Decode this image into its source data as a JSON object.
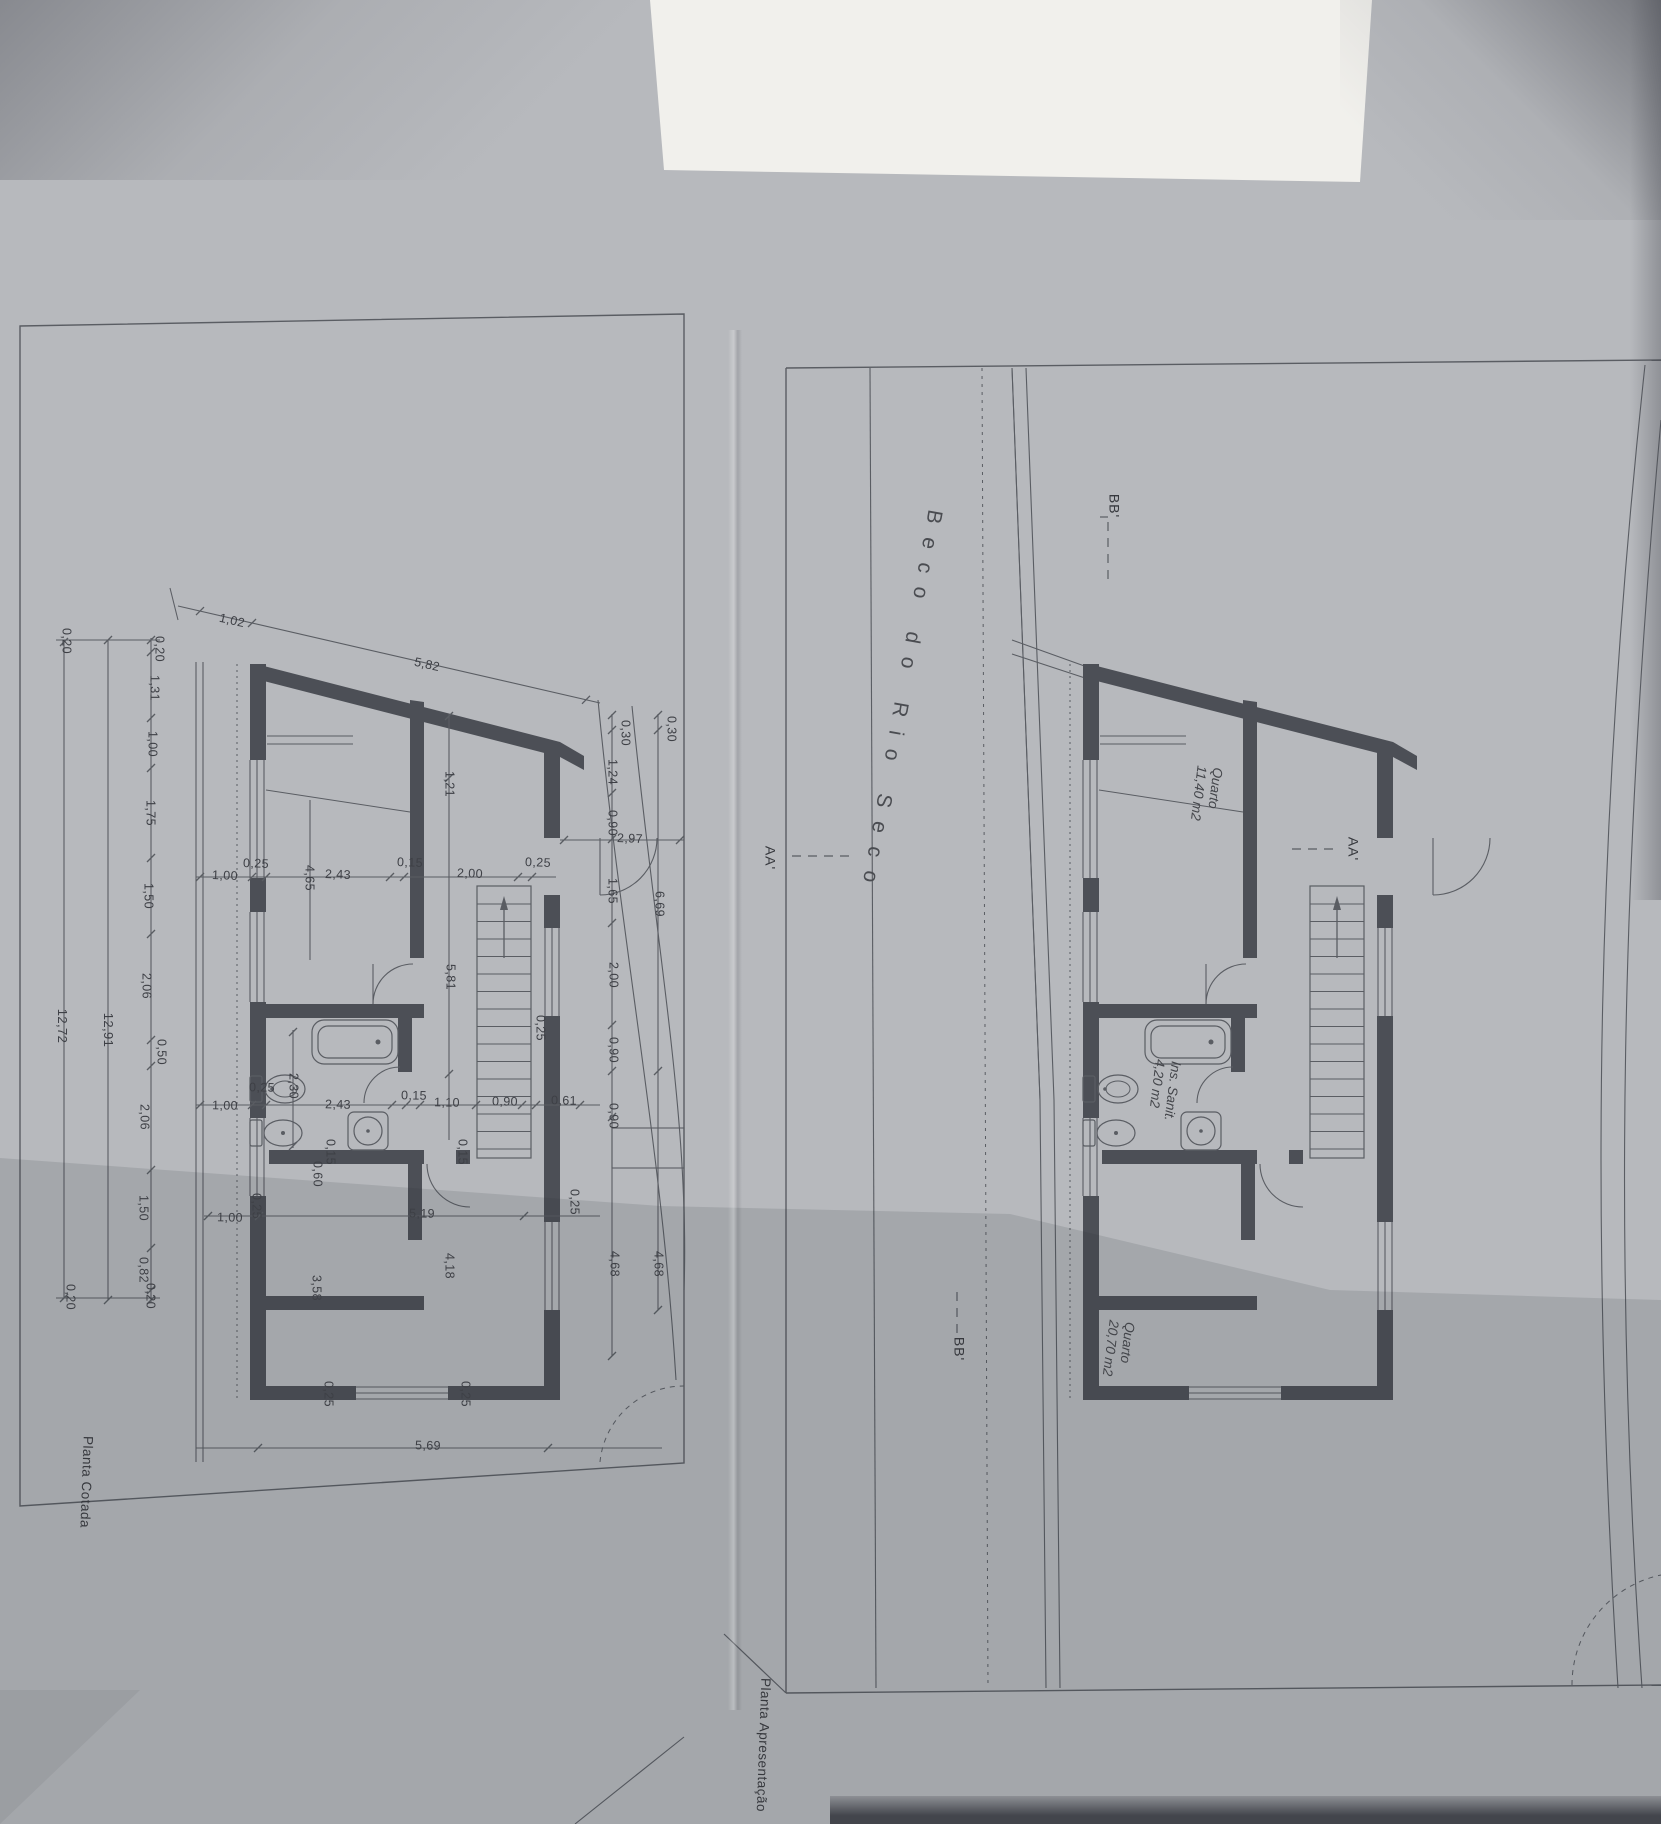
{
  "title": "Plantas de arquitetura (digitalização)",
  "street_label": {
    "text": "Beco do Rio Seco",
    "x": 901,
    "y": 703,
    "r": 100
  },
  "captions": {
    "left_plan": {
      "text": "Planta Cotada",
      "x": 86,
      "y": 1482,
      "r": 92
    },
    "right_plan": {
      "text": "Planta Apresentação",
      "x": 763,
      "y": 1745,
      "r": 92
    }
  },
  "section_markers": [
    {
      "t": "BB'",
      "x": 1114,
      "y": 506,
      "r": 90
    },
    {
      "t": "AA'",
      "x": 770,
      "y": 858,
      "r": 90
    },
    {
      "t": "AA'",
      "x": 1353,
      "y": 849,
      "r": 90
    },
    {
      "t": "BB'",
      "x": 959,
      "y": 1349,
      "r": 90
    }
  ],
  "rooms": [
    {
      "name": "Quarto",
      "area": "11,40 m2",
      "x": 1206,
      "y": 794,
      "r": 97
    },
    {
      "name": "Ins. Sanit.",
      "area": "4,20 m2",
      "x": 1164,
      "y": 1090,
      "r": 97
    },
    {
      "name": "Quarto",
      "area": "20,70 m2",
      "x": 1118,
      "y": 1349,
      "r": 97
    }
  ],
  "dimensions": [
    {
      "t": "1,02",
      "x": 232,
      "y": 621,
      "r": 13
    },
    {
      "t": "5,82",
      "x": 427,
      "y": 665,
      "r": 13
    },
    {
      "t": "0,20",
      "x": 159,
      "y": 649,
      "r": 90
    },
    {
      "t": "1,31",
      "x": 154,
      "y": 688,
      "r": 90
    },
    {
      "t": "1,00",
      "x": 152,
      "y": 744,
      "r": 90
    },
    {
      "t": "1,75",
      "x": 150,
      "y": 813,
      "r": 90
    },
    {
      "t": "1,50",
      "x": 148,
      "y": 896,
      "r": 90
    },
    {
      "t": "2,06",
      "x": 146,
      "y": 986,
      "r": 90
    },
    {
      "t": "0,50",
      "x": 161,
      "y": 1052,
      "r": 90
    },
    {
      "t": "2,06",
      "x": 144,
      "y": 1117,
      "r": 90
    },
    {
      "t": "1,50",
      "x": 143,
      "y": 1208,
      "r": 90
    },
    {
      "t": "0,82",
      "x": 143,
      "y": 1270,
      "r": 90
    },
    {
      "t": "0,20",
      "x": 150,
      "y": 1296,
      "r": 90
    },
    {
      "t": "12,91",
      "x": 108,
      "y": 1030,
      "r": 90
    },
    {
      "t": "0,20",
      "x": 66,
      "y": 641,
      "r": 90
    },
    {
      "t": "12,72",
      "x": 62,
      "y": 1026,
      "r": 90
    },
    {
      "t": "0,20",
      "x": 70,
      "y": 1297,
      "r": 90
    },
    {
      "t": "1,00",
      "x": 225,
      "y": 876,
      "r": 2
    },
    {
      "t": "0,25",
      "x": 256,
      "y": 864,
      "r": 2
    },
    {
      "t": "4,65",
      "x": 309,
      "y": 878,
      "r": 90
    },
    {
      "t": "2,43",
      "x": 338,
      "y": 875,
      "r": 2
    },
    {
      "t": "0,15",
      "x": 410,
      "y": 863,
      "r": 2
    },
    {
      "t": "2,00",
      "x": 470,
      "y": 874,
      "r": 2
    },
    {
      "t": "0,25",
      "x": 538,
      "y": 863,
      "r": 2
    },
    {
      "t": "2,97",
      "x": 630,
      "y": 839,
      "r": 2
    },
    {
      "t": "1,21",
      "x": 449,
      "y": 784,
      "r": 90
    },
    {
      "t": "5,81",
      "x": 450,
      "y": 977,
      "r": 90
    },
    {
      "t": "2,30",
      "x": 293,
      "y": 1086,
      "r": 90
    },
    {
      "t": "1,00",
      "x": 225,
      "y": 1106,
      "r": 1
    },
    {
      "t": "0,25",
      "x": 262,
      "y": 1088,
      "r": 1
    },
    {
      "t": "2,43",
      "x": 338,
      "y": 1105,
      "r": 1
    },
    {
      "t": "0,15",
      "x": 414,
      "y": 1096,
      "r": 1
    },
    {
      "t": "1,10",
      "x": 447,
      "y": 1103,
      "r": 1
    },
    {
      "t": "0,90",
      "x": 505,
      "y": 1102,
      "r": 1
    },
    {
      "t": "0,61",
      "x": 564,
      "y": 1101,
      "r": 1
    },
    {
      "t": "0,15",
      "x": 330,
      "y": 1152,
      "r": 90
    },
    {
      "t": "0,60",
      "x": 317,
      "y": 1174,
      "r": 90
    },
    {
      "t": "0,15",
      "x": 462,
      "y": 1152,
      "r": 90
    },
    {
      "t": "1,00",
      "x": 230,
      "y": 1218,
      "r": 1
    },
    {
      "t": "0,25",
      "x": 256,
      "y": 1206,
      "r": 90
    },
    {
      "t": "5,19",
      "x": 422,
      "y": 1214,
      "r": 1
    },
    {
      "t": "3,58",
      "x": 316,
      "y": 1288,
      "r": 90
    },
    {
      "t": "4,18",
      "x": 449,
      "y": 1266,
      "r": 90
    },
    {
      "t": "0,25",
      "x": 328,
      "y": 1394,
      "r": 90
    },
    {
      "t": "0,25",
      "x": 465,
      "y": 1394,
      "r": 90
    },
    {
      "t": "5,69",
      "x": 428,
      "y": 1446,
      "r": 1
    },
    {
      "t": "0,30",
      "x": 625,
      "y": 733,
      "r": 90
    },
    {
      "t": "1,24",
      "x": 612,
      "y": 772,
      "r": 90
    },
    {
      "t": "0,90",
      "x": 612,
      "y": 823,
      "r": 90
    },
    {
      "t": "1,65",
      "x": 612,
      "y": 891,
      "r": 90
    },
    {
      "t": "2,00",
      "x": 613,
      "y": 975,
      "r": 90
    },
    {
      "t": "0,90",
      "x": 613,
      "y": 1050,
      "r": 90
    },
    {
      "t": "0,90",
      "x": 613,
      "y": 1116,
      "r": 90
    },
    {
      "t": "4,68",
      "x": 614,
      "y": 1264,
      "r": 90
    },
    {
      "t": "0,30",
      "x": 671,
      "y": 729,
      "r": 90
    },
    {
      "t": "6,69",
      "x": 659,
      "y": 904,
      "r": 90
    },
    {
      "t": "4,68",
      "x": 658,
      "y": 1264,
      "r": 90
    },
    {
      "t": "0,25",
      "x": 540,
      "y": 1028,
      "r": 90
    },
    {
      "t": "0,25",
      "x": 574,
      "y": 1202,
      "r": 90
    }
  ],
  "colors": {
    "paper": "#b7b9bd",
    "white_band": "#f1f0ec",
    "line": "#5a5d63",
    "wall": "#4c4f56",
    "text": "#3e4046"
  }
}
